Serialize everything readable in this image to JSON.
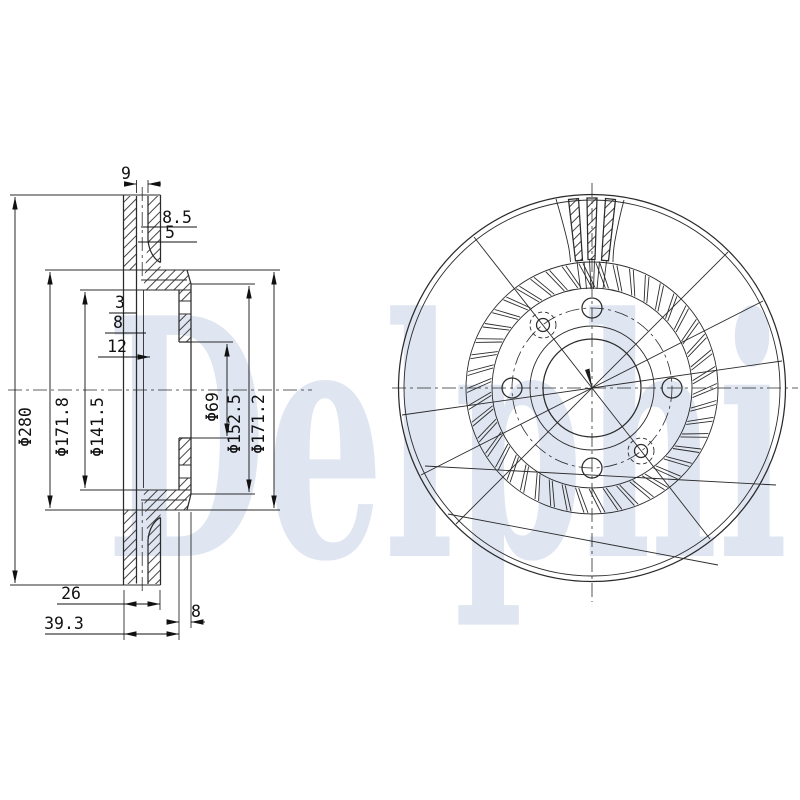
{
  "watermark": {
    "text": "Delphi"
  },
  "colors": {
    "watermark": "#dfe5f1",
    "line": "#2b2b2b",
    "dim_text": "#111111"
  },
  "section_view": {
    "dims": {
      "slot_width": "9",
      "pad_outer": "8.5",
      "pad_inner": "5",
      "wall_a": "3",
      "wall_b": "8",
      "wall_c": "12",
      "dia_outer": "Φ280",
      "dia_ring_inner": "Φ171.8",
      "dia_hat": "Φ141.5",
      "dia_bore": "Φ69",
      "dia_flange": "Φ152.5",
      "dia_shoulder": "Φ171.2",
      "ring_width": "26",
      "overall_depth": "39.3",
      "flange_thickness": "8"
    }
  }
}
